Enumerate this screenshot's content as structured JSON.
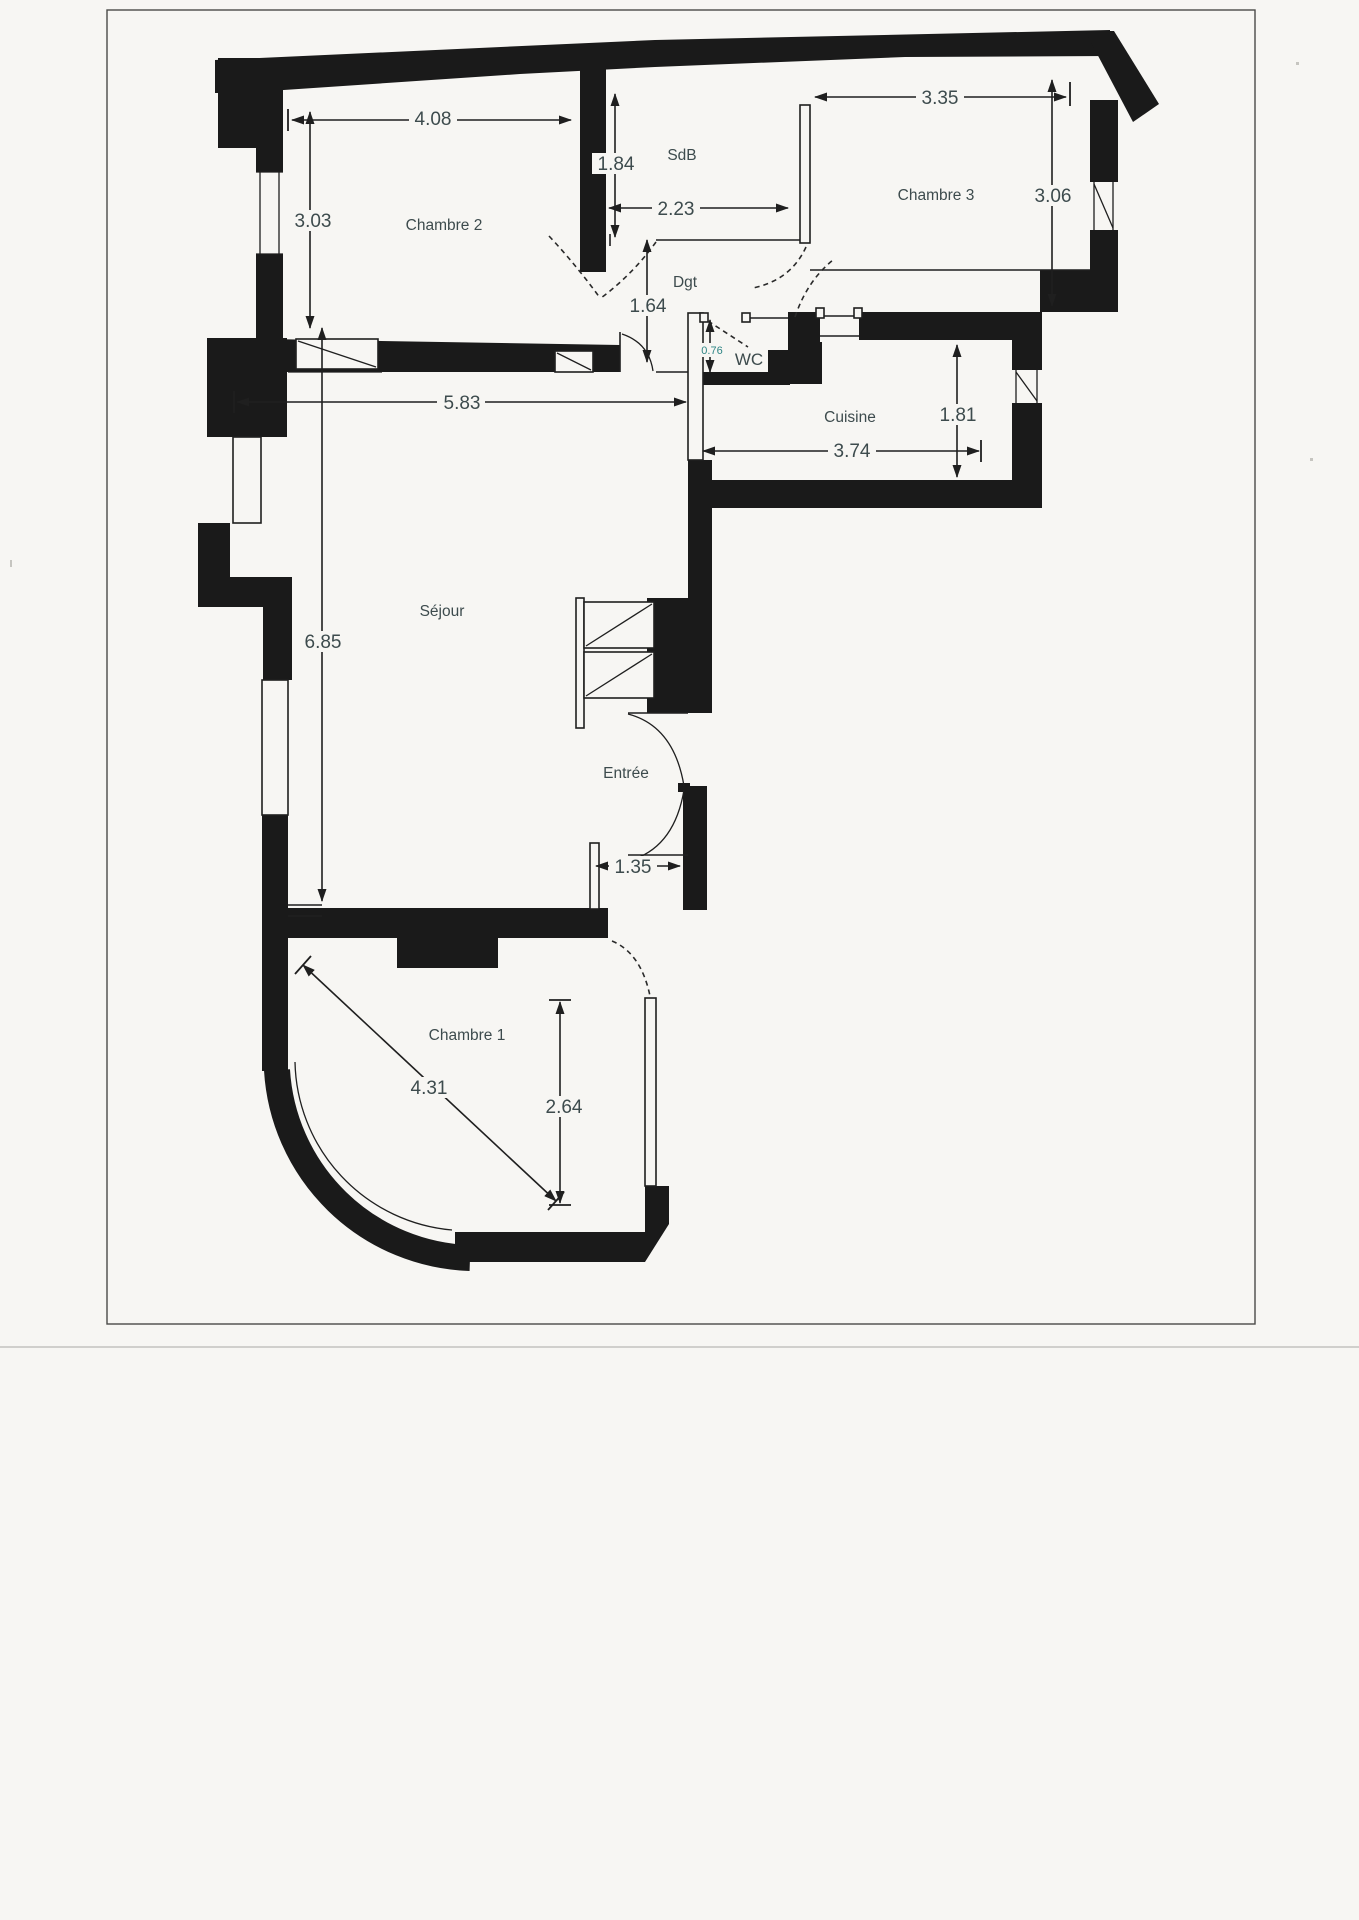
{
  "plan": {
    "rooms": [
      {
        "id": "chambre2",
        "label": "Chambre 2"
      },
      {
        "id": "sdb",
        "label": "SdB"
      },
      {
        "id": "chambre3",
        "label": "Chambre 3"
      },
      {
        "id": "dgt",
        "label": "Dgt"
      },
      {
        "id": "wc",
        "label": "WC"
      },
      {
        "id": "cuisine",
        "label": "Cuisine"
      },
      {
        "id": "sejour",
        "label": "Séjour"
      },
      {
        "id": "entree",
        "label": "Entrée"
      },
      {
        "id": "chambre1",
        "label": "Chambre 1"
      }
    ],
    "dimensions": {
      "chambre2_width": "4.08",
      "chambre2_height": "3.03",
      "sdb_height": "1.84",
      "sdb_width": "2.23",
      "chambre3_width": "3.35",
      "chambre3_height": "3.06",
      "dgt_height": "1.64",
      "wc_width": "0.76",
      "cuisine_height": "1.81",
      "cuisine_width": "3.74",
      "sejour_width": "5.83",
      "sejour_height": "6.85",
      "entree_width": "1.35",
      "chambre1_diagonal": "4.31",
      "chambre1_height": "2.64"
    },
    "colors": {
      "wall": "#1a1a1a",
      "text": "#3d4b4d",
      "accent_teal": "#2e8585",
      "paper": "#f7f6f3"
    }
  }
}
